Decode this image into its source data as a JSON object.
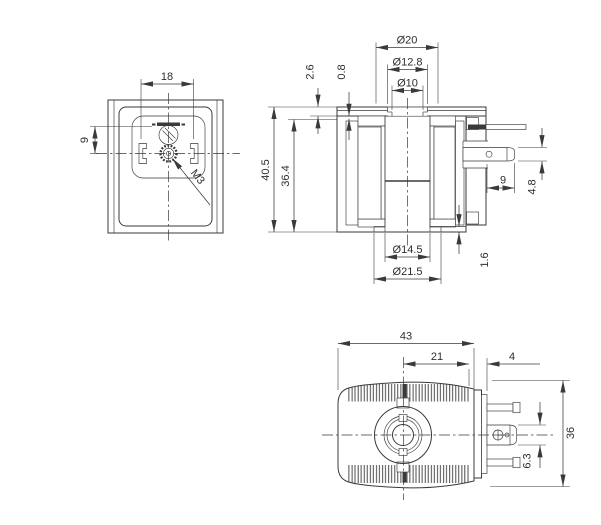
{
  "drawing": {
    "front_view": {
      "dim_width": "18",
      "dim_slot_to_center": "9",
      "thread_label": "M3"
    },
    "section_view": {
      "dim_outer_dia": "Ø20",
      "dim_mid_dia": "Ø12.8",
      "dim_inner_dia": "Ø10",
      "dim_flange": "2.6",
      "dim_lip": "0.8",
      "dim_total_height": "40.5",
      "dim_body_height": "36.4",
      "dim_terminal_len": "9",
      "dim_terminal_wid": "4.8",
      "dim_bore_dia": "Ø14.5",
      "dim_collar_dia": "Ø21.5",
      "dim_base_lip": "1.6"
    },
    "side_view": {
      "dim_total_len": "43",
      "dim_center_to_edge": "21",
      "dim_collar": "4",
      "dim_height": "36",
      "dim_pin": "6.3"
    },
    "colors": {
      "ink": "#3a3a3a",
      "background": "#ffffff"
    }
  }
}
